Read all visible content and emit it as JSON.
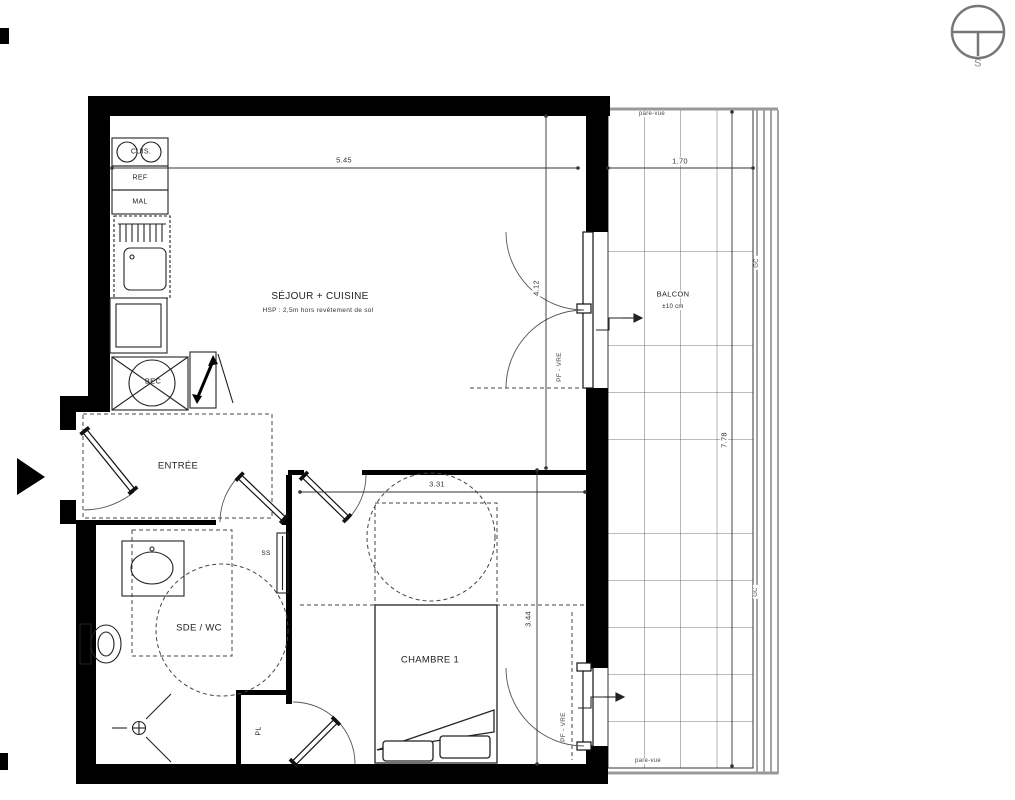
{
  "plan": {
    "compass": {
      "south_label": "S"
    },
    "rooms": {
      "sejour": {
        "name": "SÉJOUR + CUISINE",
        "ceiling_note": "HSP : 2,5m hors revêtement de sol"
      },
      "entree": {
        "name": "ENTRÉE"
      },
      "sde_wc": {
        "name": "SDE / WC"
      },
      "chambre": {
        "name": "CHAMBRE 1"
      },
      "balcon": {
        "name": "BALCON",
        "note": "±10 cm"
      },
      "placard": {
        "name": "PL"
      }
    },
    "equipment": {
      "hob": "CUIS.",
      "fridge": "REF",
      "washer": "MAL",
      "water_heater": "BEC",
      "towel_dryer": "SS"
    },
    "openings": {
      "sejour_window": "PF - VRE",
      "chambre_window": "PF - VRE"
    },
    "balcony_notes": {
      "pare_vue_top": "pare-vue",
      "pare_vue_bottom": "pare-vue",
      "gc_top": "GC",
      "gc_bottom": "GC"
    },
    "dimensions": {
      "sejour_width": "5.45",
      "balcon_width": "1.70",
      "sejour_depth": "4.12",
      "chambre_width": "3.31",
      "chambre_depth": "3.44",
      "balcon_depth": "7.78"
    }
  }
}
